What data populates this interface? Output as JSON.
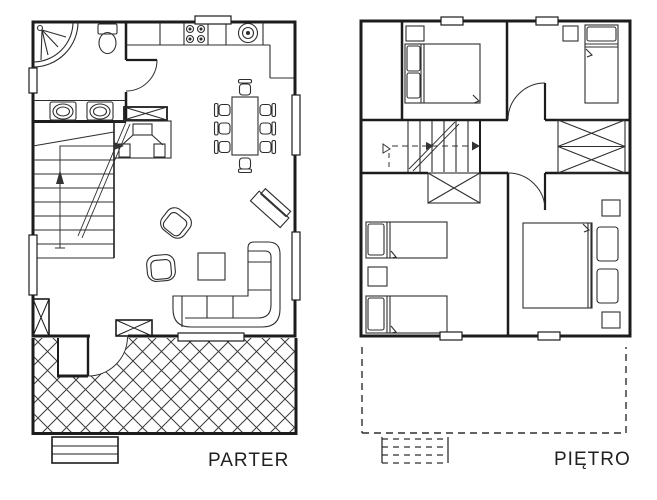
{
  "canvas": {
    "width": 657,
    "height": 500,
    "background": "#ffffff"
  },
  "colors": {
    "wall_line": "#1c1c1c",
    "furniture_line": "#2d2d2d",
    "hatch_line": "#3a3a3a",
    "label_text": "#212121"
  },
  "plans": {
    "parter": {
      "label": "PARTER",
      "features": [
        "corner-shower",
        "toilet",
        "double-washbasin",
        "bathroom-door",
        "staircase-with-up-arrow",
        "fireplace",
        "kitchen-counter",
        "stove-four-burners",
        "round-kitchen-sink",
        "dining-table",
        "eight-chairs",
        "armchair",
        "armchair",
        "coffee-table",
        "corner-sofa",
        "tv-stand",
        "chimney-flue-box",
        "entry-door",
        "hatched-terrace",
        "entry-steps",
        "windows"
      ]
    },
    "pietro": {
      "label": "PIĘTRO",
      "features": [
        "double-bed",
        "single-bed",
        "two-single-beds",
        "double-bed",
        "nightstands",
        "built-in-wardrobe",
        "staircase-dashed-direction-line",
        "under-stair-wardrobe",
        "bedroom-doors",
        "dashed-roof-terrace-outline",
        "dashed-steps",
        "windows"
      ]
    }
  }
}
